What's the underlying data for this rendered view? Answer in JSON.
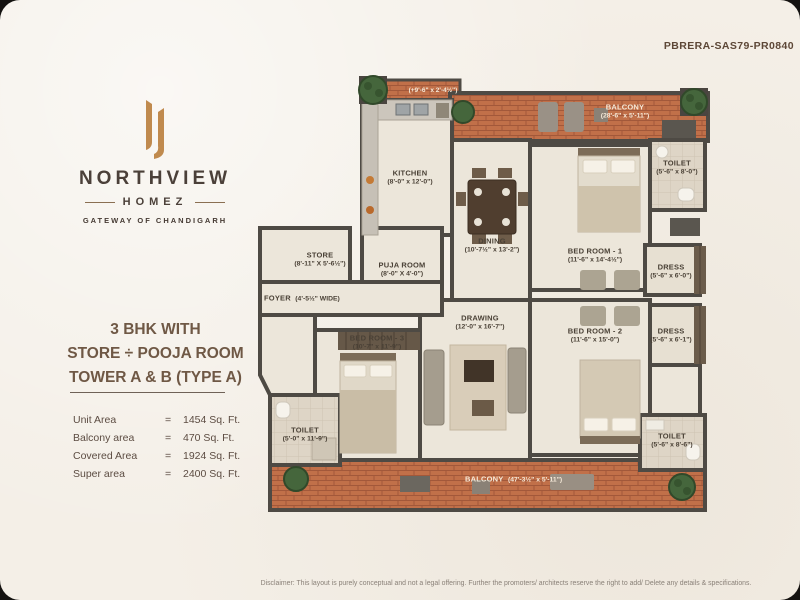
{
  "meta": {
    "rera_number": "PBRERA-SAS79-PR0840",
    "disclaimer": "Disclaimer: This layout is purely conceptual and not a legal offering. Further the promoters/ architects reserve the right to add/ Delete any details & specifications."
  },
  "brand": {
    "name": "NORTHVIEW",
    "subname": "HOMEZ",
    "tagline": "GATEWAY OF CHANDIGARH"
  },
  "unit": {
    "title": {
      "line1": "3 BHK WITH",
      "line2": "STORE ÷ POOJA ROOM",
      "line3": "TOWER A & B (TYPE A)"
    },
    "areas": [
      {
        "label": "Unit Area",
        "eq": "=",
        "value": "1454 Sq. Ft."
      },
      {
        "label": "Balcony area",
        "eq": "=",
        "value": "470 Sq. Ft."
      },
      {
        "label": "Covered Area",
        "eq": "=",
        "value": "1924 Sq. Ft."
      },
      {
        "label": "Super area",
        "eq": "=",
        "value": "2400 Sq. Ft."
      }
    ]
  },
  "floorplan": {
    "rooms": {
      "strip": {
        "dims": "(+9'-6\" x 2'-4½\")"
      },
      "balcony_top": {
        "name": "BALCONY",
        "dims": "(28'-6\" x 5'-11\")"
      },
      "toilet1": {
        "name": "TOILET",
        "dims": "(5'-6\" x 8'-0\")"
      },
      "kitchen": {
        "name": "KITCHEN",
        "dims": "(8'-0\" x 12'-0\")"
      },
      "dining": {
        "name": "DINING",
        "dims": "(10'-7½\" x 13'-2\")"
      },
      "bedroom1": {
        "name": "BED ROOM - 1",
        "dims": "(11'-6\" x 14'-4½\")"
      },
      "dress1": {
        "name": "DRESS",
        "dims": "(5'-6\" x 6'-0\")"
      },
      "store": {
        "name": "STORE",
        "dims": "(8'-11\" X 5'-6½\")"
      },
      "puja": {
        "name": "PUJA ROOM",
        "dims": "(8'-0\" X 4'-0\")"
      },
      "foyer": {
        "name": "FOYER",
        "dims": "(4'-5½\" WIDE)"
      },
      "drawing": {
        "name": "DRAWING",
        "dims": "(12'-0\" x 16'-7\")"
      },
      "bedroom3": {
        "name": "BED ROOM - 3",
        "dims": "(10'-7\" x 11'-9\")"
      },
      "bedroom2": {
        "name": "BED ROOM - 2",
        "dims": "(11'-6\" x 15'-0\")"
      },
      "dress2": {
        "name": "DRESS",
        "dims": "(5'-6\" x 6'-1\")"
      },
      "toilet2": {
        "name": "TOILET",
        "dims": "(5'-0\" x 11'-9\")"
      },
      "toilet3": {
        "name": "TOILET",
        "dims": "(5'-6\" x 8'-6\")"
      },
      "balcony_bottom": {
        "name": "BALCONY",
        "dims": "(47'-3½\" x 5'-11\")"
      }
    }
  },
  "colors": {
    "gold": "#c08a4e",
    "title_brown": "#6f5845",
    "wall": "#4e4a44",
    "brick": "#c17049",
    "floor": "#ece6da"
  }
}
